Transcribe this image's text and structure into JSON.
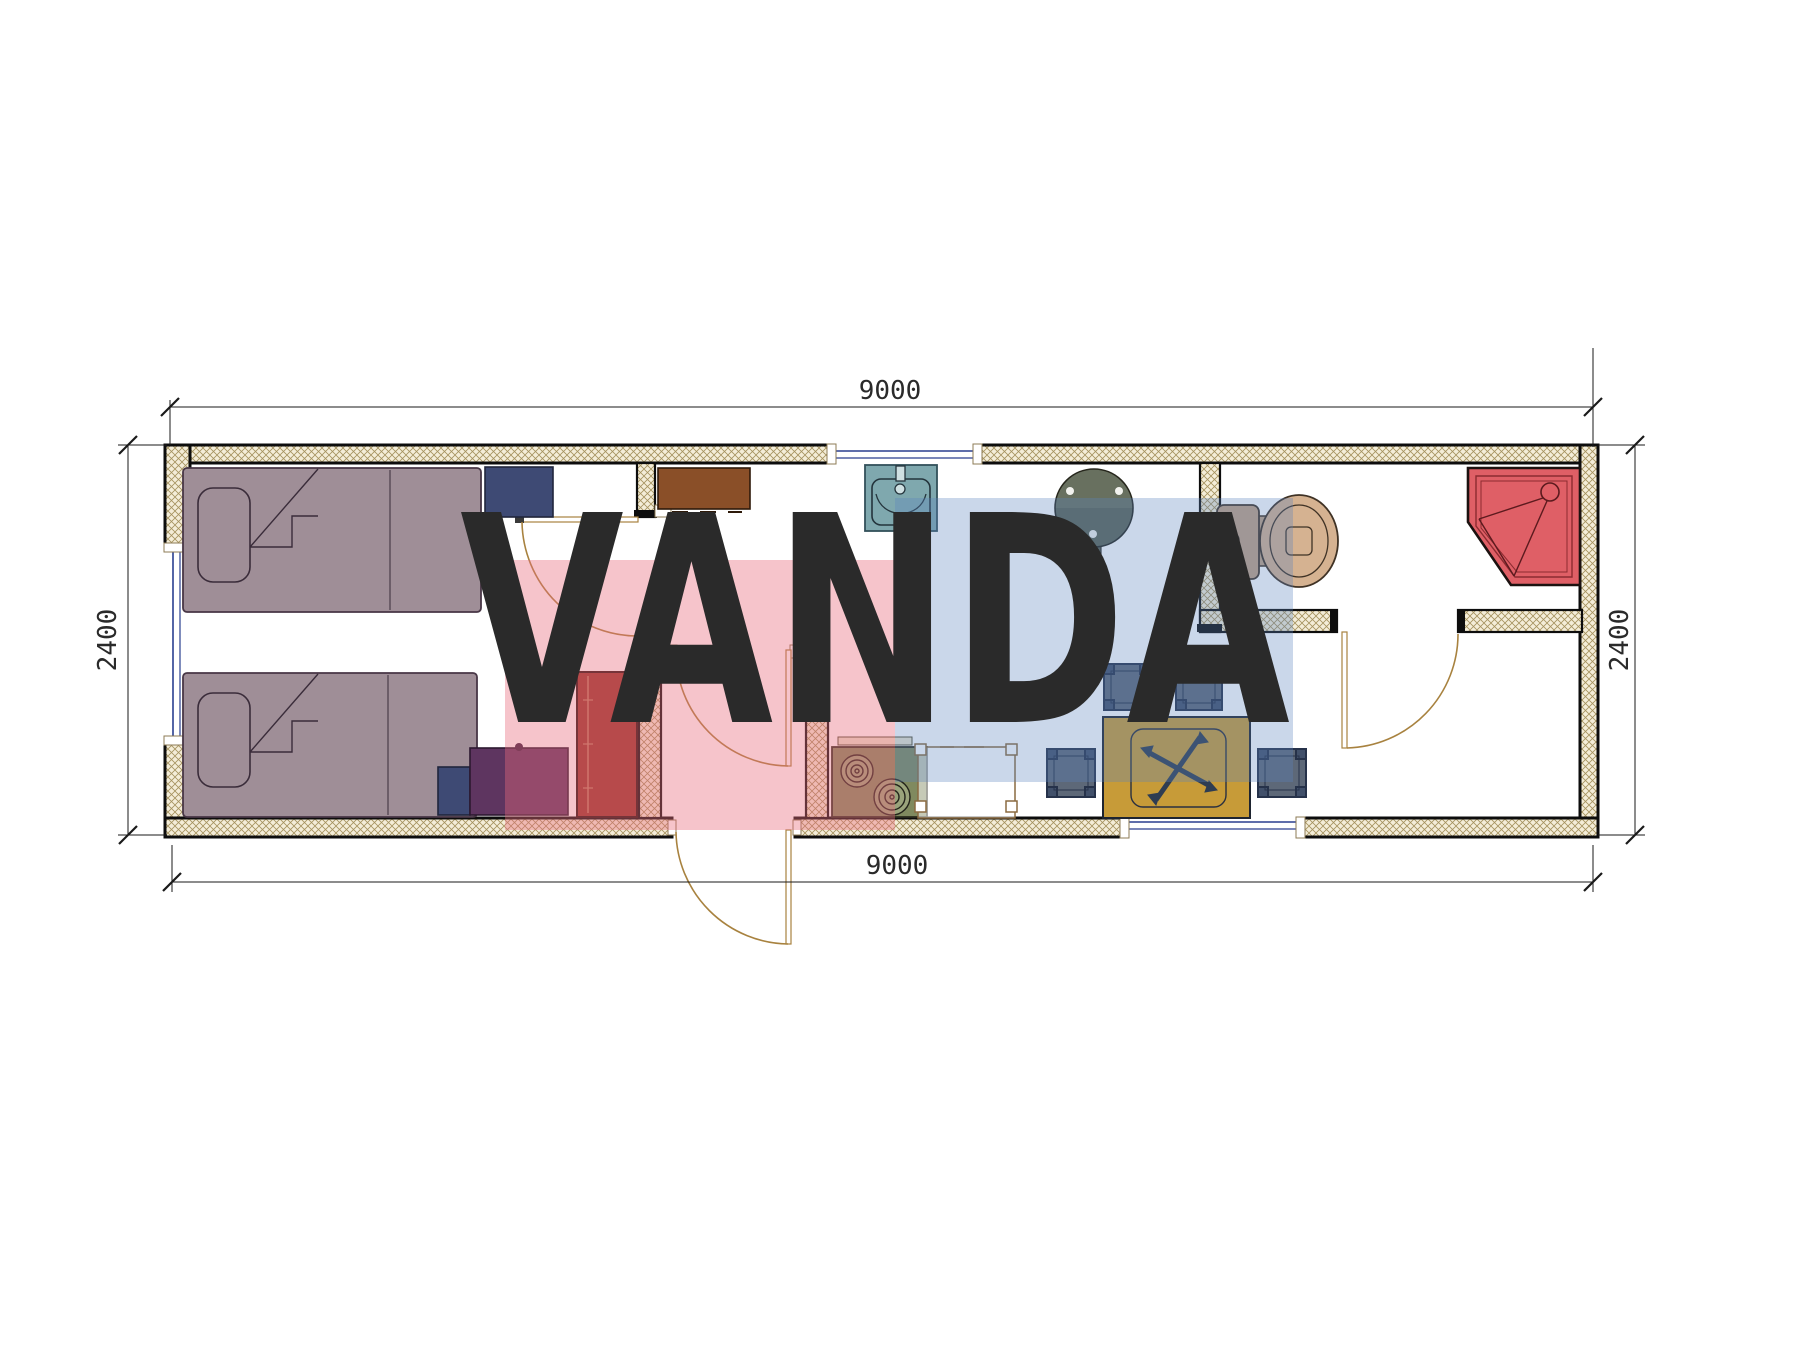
{
  "drawing": {
    "type": "floor-plan",
    "module_width_mm": "9000",
    "module_depth_mm": "2400"
  },
  "dimensions": {
    "top": "9000",
    "bottom": "9000",
    "left": "2400",
    "right": "2400"
  },
  "watermark": {
    "text": "VANDA",
    "pink_fill": "rgba(233,108,125,0.40)",
    "blue_fill": "rgba(90,130,190,0.32)",
    "text_fill": "rgba(255,255,255,0.58)"
  },
  "palette": {
    "wall_hatch_bg": "#f4edd8",
    "wall_hatch_line": "#a5925e",
    "wall_outline": "#0d0d0d",
    "bed": "#9f8e97",
    "bed_outline": "#473645",
    "navy_cabinet": "#3e4a74",
    "purple_cabinet": "#5e3560",
    "wardrobe_red": "#97352a",
    "brown_cabinet": "#8a4f28",
    "sink": "#7fa8ae",
    "round_table": "#68705f",
    "toilet_tank": "#c2a184",
    "toilet_bowl": "#d5b291",
    "shower": "#df5f66",
    "stove": "#808a5f",
    "dining_table": "#c79b38",
    "stool": "#5d6878",
    "stool_outline": "#26324a",
    "door_arc": "#a8823f",
    "window_line": "#2a3f8f",
    "counter_outline": "#8a6a40",
    "dim_line": "#1a1a1a"
  }
}
